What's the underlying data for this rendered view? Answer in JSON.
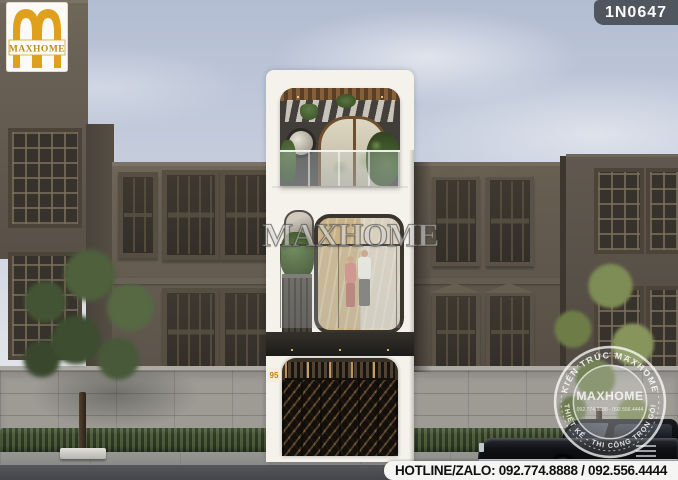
{
  "branding": {
    "logo_text": "MAXHOME",
    "design_code": "1N0647",
    "watermark": "MAXHOME",
    "stamp": {
      "arc_top": "KIẾN TRÚC MAXHOME",
      "arc_bottom": "THIẾT KẾ - THI CÔNG TRỌN GÓI",
      "center": "MAXHOME",
      "phone": "092.774.8888 - 092.556.4444"
    },
    "hotline": "HOTLINE/ZALO: 092.774.8888 / 092.556.4444"
  },
  "scene": {
    "house_number": "95"
  },
  "colors": {
    "brand_gold": "#DFA11D",
    "code_badge_bg": "#4B5158",
    "hotline_bg": "#F5F5F3",
    "hotline_text": "#101010",
    "facade_white": "#F5F2EB",
    "building_brown": "#5E564B",
    "gate_bronze": "#3A3127",
    "sky_top": "#B8C2D5",
    "foliage_dark": "#47573A",
    "foliage_light": "#76854D",
    "stamp_white": "#FFFFFF"
  }
}
